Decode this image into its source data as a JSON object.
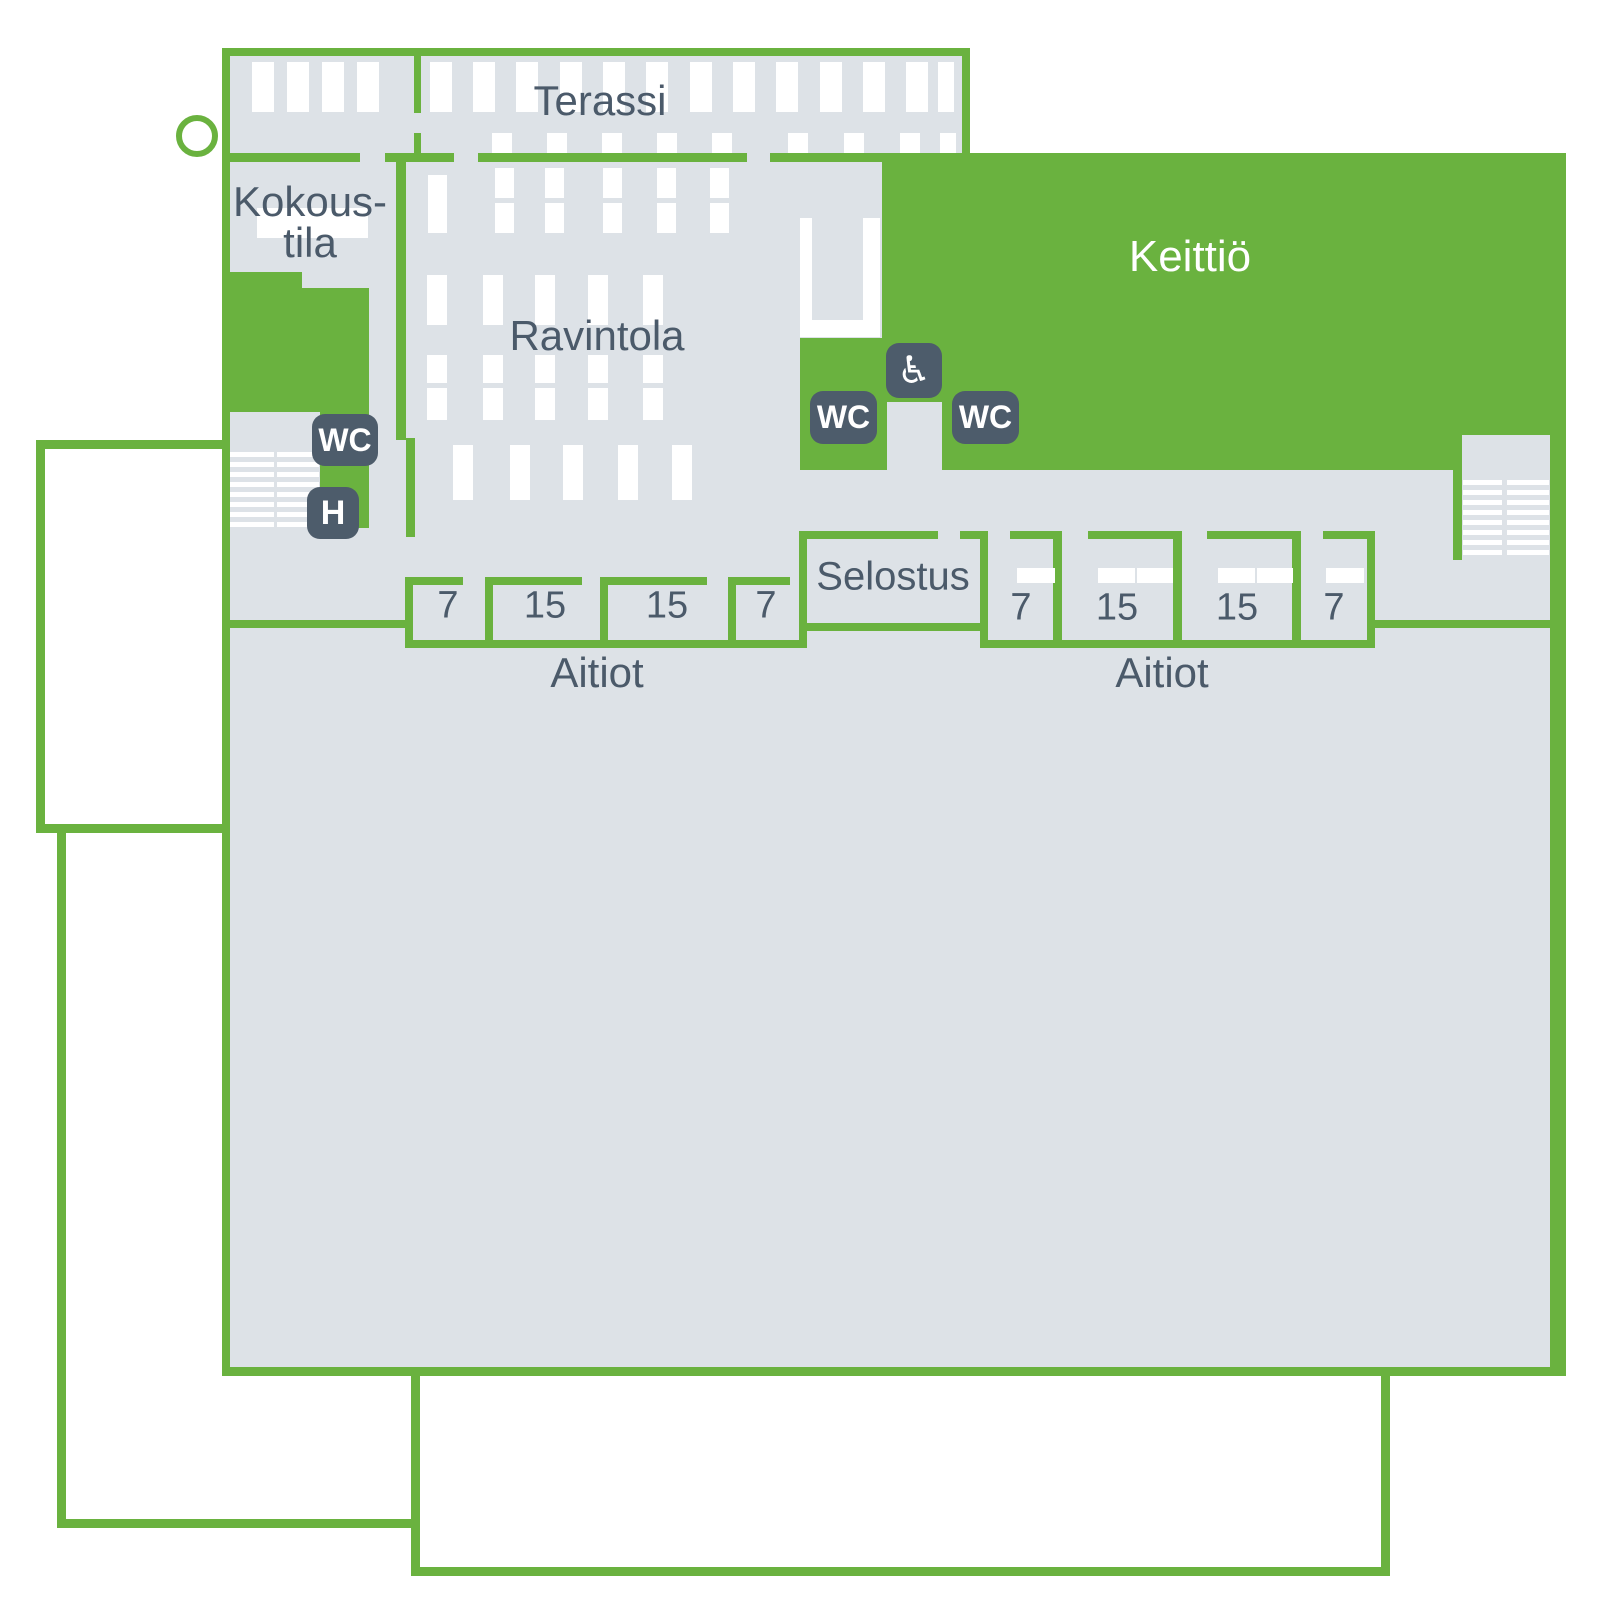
{
  "colors": {
    "accent_green": "#6ab23f",
    "room_gray": "#dde2e7",
    "badge_slate": "#4d5c6b",
    "text_slate": "#4b5a6a",
    "furniture_white": "#ffffff"
  },
  "rooms": {
    "terassi": "Terassi",
    "kokoustila_line1": "Kokous-",
    "kokoustila_line2": "tila",
    "ravintola": "Ravintola",
    "keittio": "Keittiö",
    "selostus": "Selostus"
  },
  "badges": {
    "wc_left": "WC",
    "h_left": "H",
    "wc_mid_left": "WC",
    "wc_mid_right": "WC",
    "accessible_icon": "♿"
  },
  "aitiot": {
    "label_left": "Aitiot",
    "label_right": "Aitiot",
    "left_group_cells": [
      "7",
      "15",
      "15",
      "7"
    ],
    "right_group_cells": [
      "7",
      "15",
      "15",
      "7"
    ]
  }
}
